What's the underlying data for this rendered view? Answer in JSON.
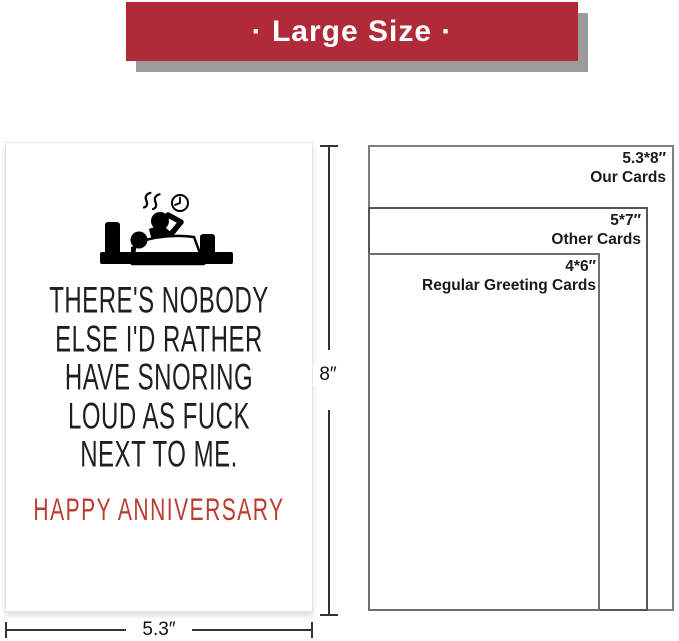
{
  "banner": {
    "label": "· Large Size ·",
    "bg_color": "#b12a3a",
    "shadow_color": "#9b9b9b",
    "text_color": "#ffffff"
  },
  "card": {
    "icon": "couple-in-bed-snoring-clock-icon",
    "quote_lines": [
      "THERE'S NOBODY",
      "ELSE I'D RATHER",
      "HAVE SNORING",
      "LOUD AS FUCK",
      "NEXT TO ME."
    ],
    "greeting": "HAPPY ANNIVERSARY",
    "greeting_color": "#bd3a31",
    "quote_color": "#1f1f1f"
  },
  "dimensions": {
    "height_label": "8″",
    "width_label": "5.3″"
  },
  "size_comparison": {
    "rects": [
      {
        "size": "5.3*8″",
        "label": "Our Cards"
      },
      {
        "size": "5*7″",
        "label": "Other Cards"
      },
      {
        "size": "4*6″",
        "label": "Regular Greeting Cards"
      }
    ]
  }
}
